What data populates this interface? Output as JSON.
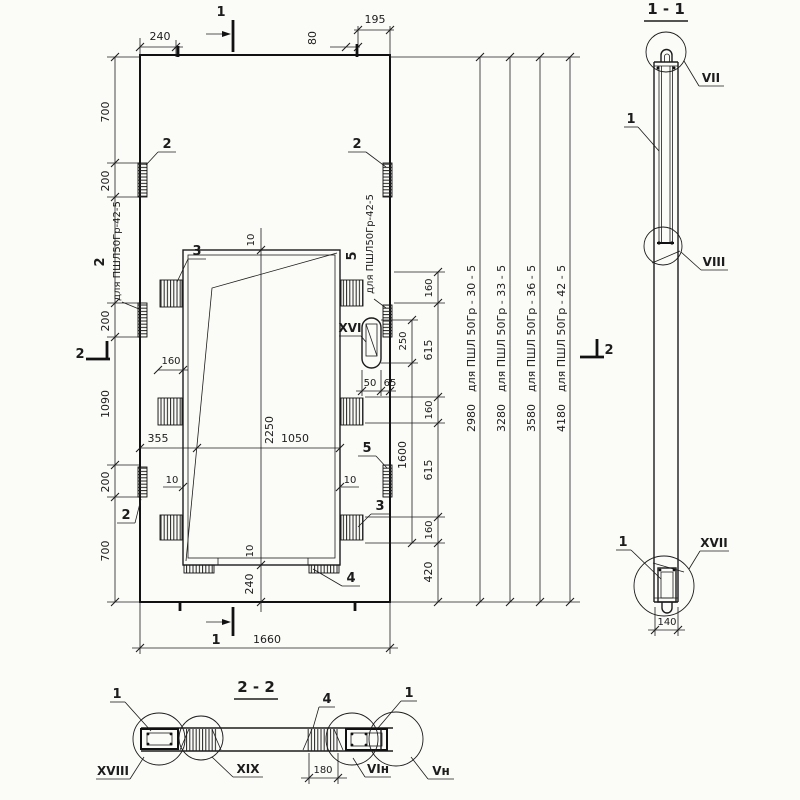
{
  "plan": {
    "dims": {
      "top_240": "240",
      "top_80": "80",
      "top_195": "195",
      "bottom_1660": "1660",
      "left_700a": "700",
      "left_200a": "200",
      "left_200b": "200",
      "left_1090": "1090",
      "left_200c": "200",
      "left_700b": "700",
      "mid_10_top": "10",
      "mid_2250": "2250",
      "mid_355": "355",
      "mid_1050": "1050",
      "mid_160": "160",
      "mid_10_left": "10",
      "mid_10_right": "10",
      "mid_10_bot": "10",
      "mid_240": "240",
      "right_160a": "160",
      "right_615a": "615",
      "right_160b": "160",
      "right_615b": "615",
      "right_160c": "160",
      "right_420": "420",
      "right_250": "250",
      "right_1600": "1600",
      "right_50": "50",
      "right_65": "65"
    },
    "items": {
      "i1": "1",
      "i2": "2",
      "i3": "3",
      "i4": "4",
      "i5": "5"
    },
    "details": {
      "xvi": "XVI"
    },
    "sections": {
      "s1": "1",
      "s2": "2"
    },
    "notes": {
      "left_text": "для ПШЛ50Гр-42-5",
      "right_text": "для ПШЛ50Гр-42-5"
    },
    "variants": [
      {
        "value": "2980",
        "note": "для ПШЛ 50Гр - 30 - 5"
      },
      {
        "value": "3280",
        "note": "для ПШЛ 50Гр - 33 - 5"
      },
      {
        "value": "3580",
        "note": "для ПШЛ 50Гр - 36 - 5"
      },
      {
        "value": "4180",
        "note": "для ПШЛ 50Гр - 42 - 5"
      }
    ]
  },
  "section_1_1": {
    "title": "1 - 1",
    "item1": "1",
    "detail_vii": "VII",
    "detail_viii": "VIII",
    "detail_xvii": "XVII",
    "dim_140": "140"
  },
  "section_2_2": {
    "title": "2 - 2",
    "item1": "1",
    "item4": "4",
    "detail_xviii": "XVIII",
    "detail_xix": "XIX",
    "detail_vi_n": "VIн",
    "detail_v_n": "Vн",
    "dim_180": "180"
  }
}
